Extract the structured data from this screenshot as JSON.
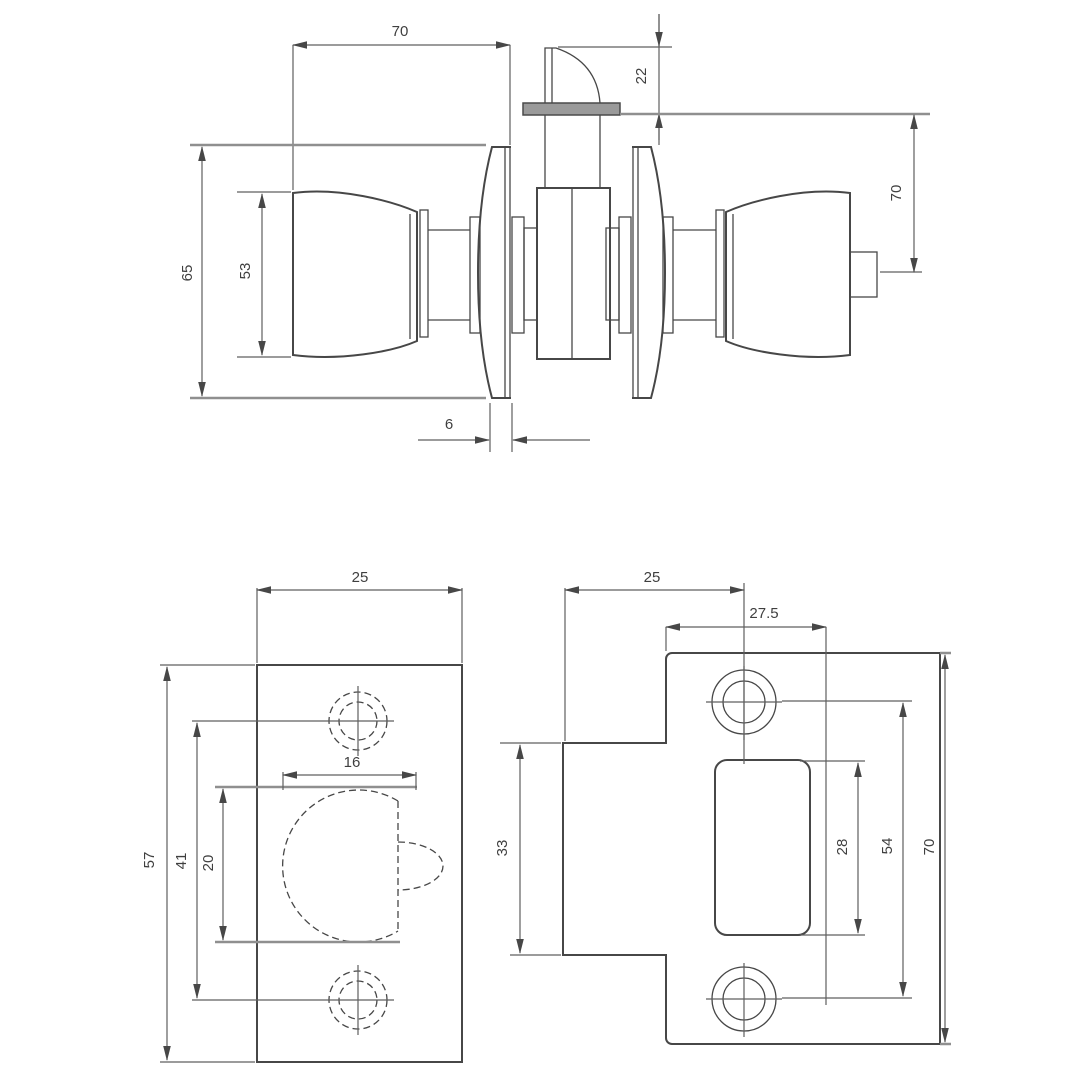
{
  "drawing": {
    "type": "engineering-drawing",
    "subject": "tubular door knob lockset with latch and strike plate",
    "units": "mm",
    "background": "#ffffff",
    "line_color": "#474747",
    "dim_line_color": "#5f5f5f",
    "heavy_ref_line_color": "#8f8f8f",
    "latch_faceplate_fill": "#9a9a9a",
    "views": {
      "knob_side_view": {
        "name": "knob assembly side view",
        "dims": {
          "knob_projection": "70",
          "latch_bolt_throw": "22",
          "backset": "70",
          "rose_diameter": "65",
          "knob_diameter": "53",
          "rose_thickness": "6"
        }
      },
      "latch_faceplate_view": {
        "name": "latch faceplate front view",
        "dims": {
          "plate_width": "25",
          "bolt_width": "16",
          "plate_height": "57",
          "screw_hole_spacing": "41",
          "bolt_height": "20"
        }
      },
      "strike_plate_view": {
        "name": "strike plate front view",
        "dims": {
          "lip_edge_to_center": "25",
          "edge_to_opening": "27.5",
          "lip_height": "33",
          "opening_height": "28",
          "screw_hole_spacing": "54",
          "plate_height": "70"
        }
      }
    }
  }
}
